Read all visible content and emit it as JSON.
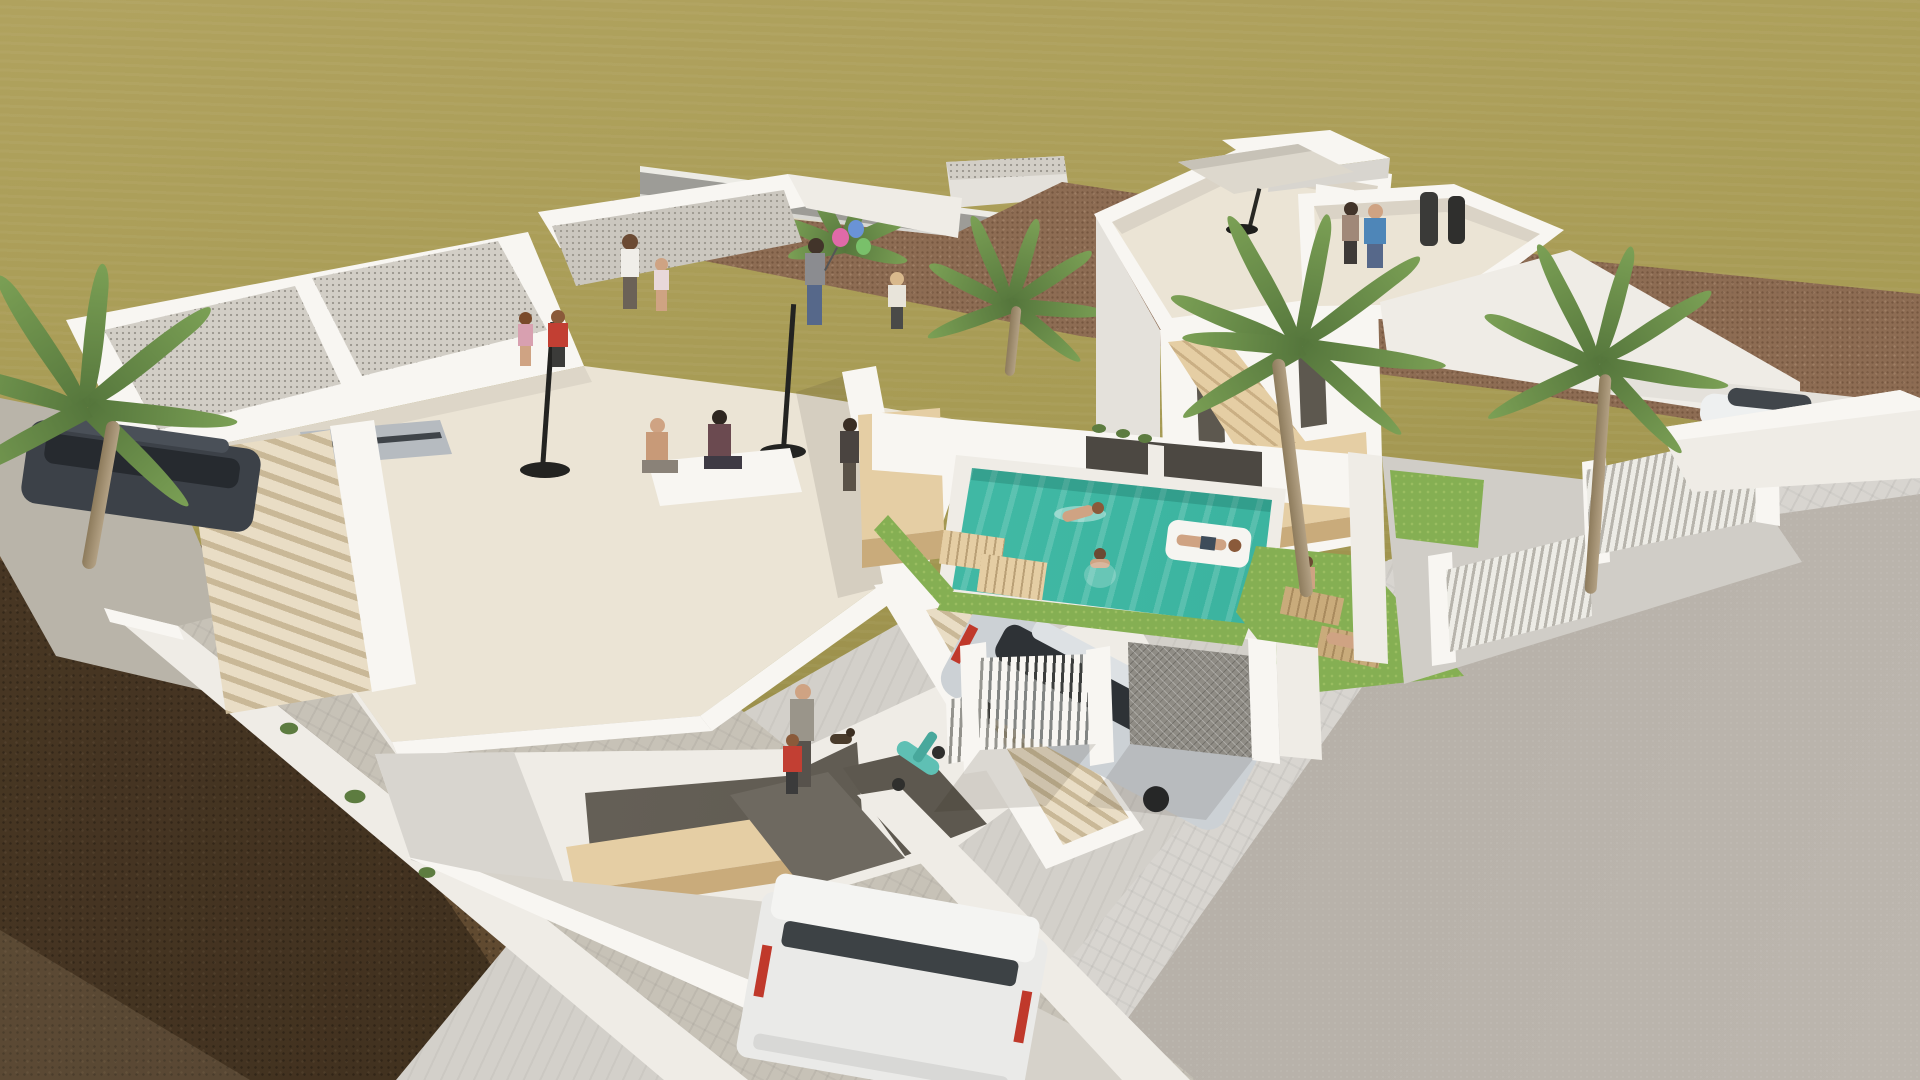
{
  "palette": {
    "field1": "#b0a25e",
    "field2": "#a79b54",
    "field3": "#958a47",
    "road": "#9d9c97",
    "roadline": "#ecebe5",
    "dirt": "#8d6c53",
    "soilshadow": "rgba(25,17,10,0.42)",
    "asphalt": "#aaa49c",
    "paver": "#d8d5d0",
    "apron": "#d3d0ca",
    "white1": "#f8f6f2",
    "white2": "#efece6",
    "white3": "#e4e1db",
    "white4": "#d8d5cf",
    "white5": "#cfccc5",
    "cream": "#ebe4d5",
    "gravel": "#d2cec6",
    "wood1": "#e5cea4",
    "wood2": "#c9ab7b",
    "stepA": "#e9ddc5",
    "stepB": "#c9b897",
    "glass": "#5d584f",
    "glass2": "#6e6960",
    "teal1": "#52c9b2",
    "teal2": "#2fa896",
    "grass": "#85af53",
    "palm1": "#7ba055",
    "palm2": "#55763c",
    "trunkc": "#a4906c",
    "skin": "#cfa383",
    "dark": "#3a3a38",
    "blue": "#4e86b8",
    "red": "#c23f33",
    "jeans": "#56688a",
    "vanwhite": "#eaeae8",
    "silver": "#ccd1d5",
    "suv": "#3c4148",
    "taillight": "#c0392b",
    "scooter": "#5fc0b4"
  },
  "scene": {
    "type": "aerial 3D architectural rendering, two modern white villas",
    "ground_areas": [
      "olive-green field",
      "brown tilled dirt strip",
      "back access road with white edge lines",
      "dark soil with palm shadows",
      "asphalt street",
      "paved sidewalk and driveways"
    ],
    "left_villa": {
      "features": [
        "two gravel flat roofs",
        "large roof terrace",
        "two closed patio umbrellas",
        "wooden balcony front",
        "dark glass doors",
        "two exterior staircases",
        "courtyard"
      ],
      "people_on_roofs": 9,
      "people_in_courtyard": 2,
      "dog": 1
    },
    "right_villa": {
      "features": [
        "three-storey tower",
        "roof terrace with gray parasol",
        "pointed roof deck",
        "wooden stair balustrade",
        "wooden balcony",
        "carport",
        "white slat fences"
      ],
      "people_on_roof": 4
    },
    "pool": {
      "swimmers": 2,
      "person_on_float": 1,
      "wooden_loungers": 2,
      "grass_edges": 2
    },
    "side_garden": {
      "wooden_loungers": 2,
      "people": 2
    },
    "vehicles": [
      "dark SUV",
      "gray parked car",
      "white van",
      "silver hatchback",
      "white sedan",
      "teal scooter"
    ],
    "palm_trees": 5
  }
}
